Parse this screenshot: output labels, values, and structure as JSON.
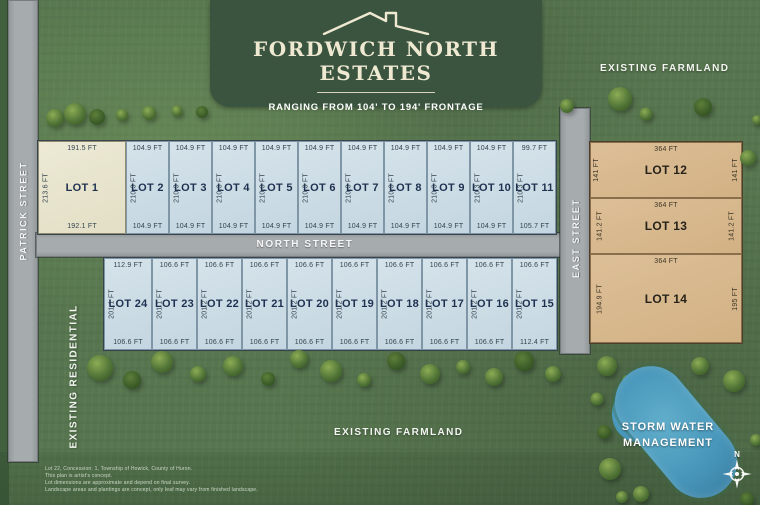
{
  "banner": {
    "title": "FORDWICH NORTH ESTATES",
    "subtitle": "RANGING FROM 104' TO 194' FRONTAGE"
  },
  "streets": {
    "patrick": "PATRICK STREET",
    "north": "NORTH STREET",
    "east": "EAST STREET"
  },
  "areas": {
    "farmland_top": "EXISTING FARMLAND",
    "farmland_bottom": "EXISTING FARMLAND",
    "residential": "EXISTING RESIDENTIAL",
    "storm_water_line1": "STORM WATER",
    "storm_water_line2": "MANAGEMENT"
  },
  "compass": {
    "north_label": "N"
  },
  "colors": {
    "grass": "#57764f",
    "banner": "#3a5440",
    "lot-blue": "#cdddE7",
    "lot-cream": "#eae7d2",
    "lot-tan": "#d9b98f",
    "road": "#a6abad",
    "pond": "#4796ba"
  },
  "lots": {
    "north_row": [
      {
        "id": "LOT 1",
        "top": "191.5 FT",
        "side": "213.6 FT",
        "bottom": "192.1 FT"
      },
      {
        "id": "LOT 2",
        "top": "104.9 FT",
        "side": "210.3 FT",
        "bottom": "104.9 FT"
      },
      {
        "id": "LOT 3",
        "top": "104.9 FT",
        "side": "210.3 FT",
        "bottom": "104.9 FT"
      },
      {
        "id": "LOT 4",
        "top": "104.9 FT",
        "side": "210.3 FT",
        "bottom": "104.9 FT"
      },
      {
        "id": "LOT 5",
        "top": "104.9 FT",
        "side": "210.3 FT",
        "bottom": "104.9 FT"
      },
      {
        "id": "LOT 6",
        "top": "104.9 FT",
        "side": "210.3 FT",
        "bottom": "104.9 FT"
      },
      {
        "id": "LOT 7",
        "top": "104.9 FT",
        "side": "210.3 FT",
        "bottom": "104.9 FT"
      },
      {
        "id": "LOT 8",
        "top": "104.9 FT",
        "side": "210.3 FT",
        "bottom": "104.9 FT"
      },
      {
        "id": "LOT 9",
        "top": "104.9 FT",
        "side": "210.3 FT",
        "bottom": "104.9 FT"
      },
      {
        "id": "LOT 10",
        "top": "104.9 FT",
        "side": "210.3 FT",
        "bottom": "104.9 FT"
      },
      {
        "id": "LOT 11",
        "top": "99.7 FT",
        "side": "210.3 FT",
        "bottom": "105.7 FT"
      }
    ],
    "south_row": [
      {
        "id": "LOT 24",
        "top": "112.9 FT",
        "side": "201.1 FT",
        "bottom": "106.6 FT"
      },
      {
        "id": "LOT 23",
        "top": "106.6 FT",
        "side": "201.1 FT",
        "bottom": "106.6 FT"
      },
      {
        "id": "LOT 22",
        "top": "106.6 FT",
        "side": "201.2 FT",
        "bottom": "106.6 FT"
      },
      {
        "id": "LOT 21",
        "top": "106.6 FT",
        "side": "201.2 FT",
        "bottom": "106.6 FT"
      },
      {
        "id": "LOT 20",
        "top": "106.6 FT",
        "side": "201.2 FT",
        "bottom": "106.6 FT"
      },
      {
        "id": "LOT 19",
        "top": "106.6 FT",
        "side": "201.2 FT",
        "bottom": "106.6 FT"
      },
      {
        "id": "LOT 18",
        "top": "106.6 FT",
        "side": "201.2 FT",
        "bottom": "106.6 FT"
      },
      {
        "id": "LOT 17",
        "top": "106.6 FT",
        "side": "201.2 FT",
        "bottom": "106.6 FT"
      },
      {
        "id": "LOT 16",
        "top": "106.6 FT",
        "side": "201.2 FT",
        "bottom": "106.6 FT"
      },
      {
        "id": "LOT 15",
        "top": "106.6 FT",
        "side": "201.2 FT",
        "bottom": "112.4 FT"
      }
    ],
    "east_column": [
      {
        "id": "LOT 12",
        "top": "364 FT",
        "left": "141 FT",
        "right": "141 FT"
      },
      {
        "id": "LOT 13",
        "top": "364 FT",
        "left": "141.2 FT",
        "right": "141.2 FT"
      },
      {
        "id": "LOT 14",
        "top": "364 FT",
        "left": "194.9 FT",
        "right": "195 FT"
      }
    ]
  },
  "footnotes": [
    "Lot 22, Concession: 1, Township of Howick, County of Huron.",
    "This plan is artist's concept.",
    "Lot dimensions are approximate and depend on final survey.",
    "Landscape areas and plantings are concept, only leaf may vary from finished landscape."
  ]
}
